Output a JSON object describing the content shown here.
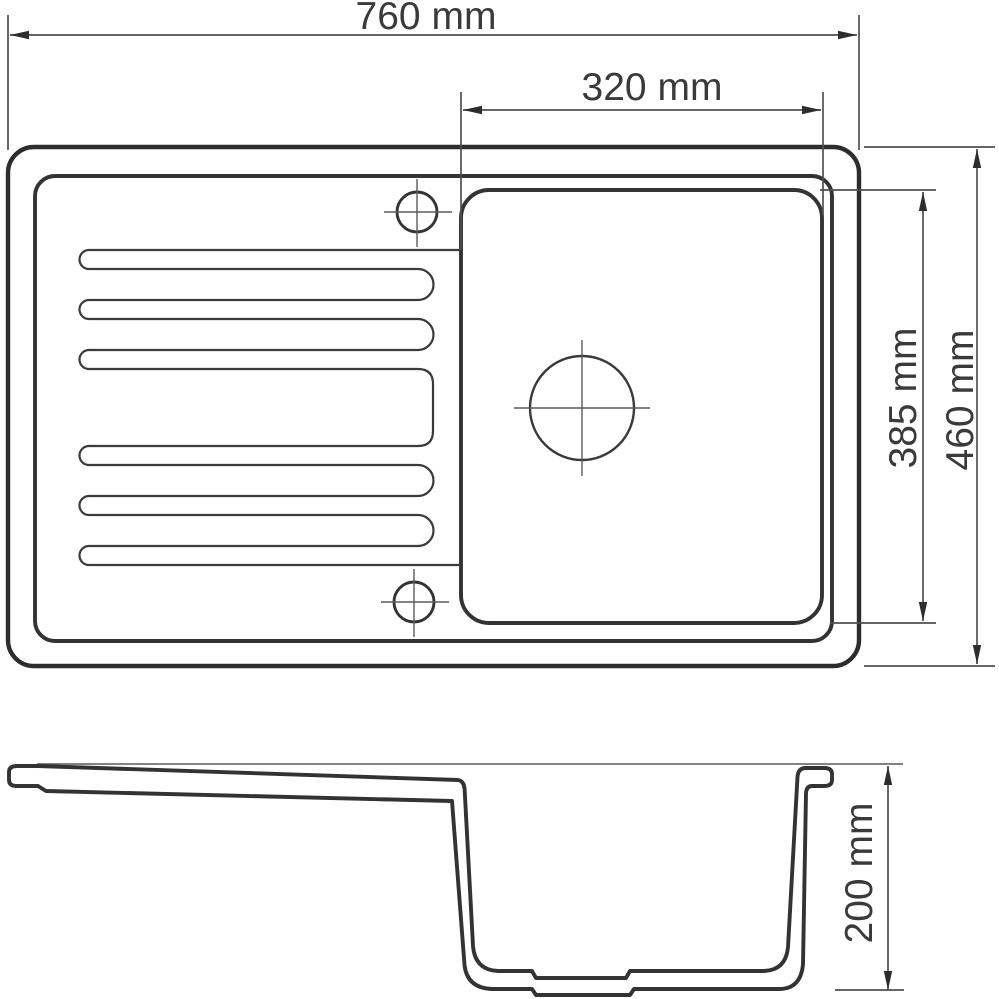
{
  "drawing": {
    "background": "#ffffff",
    "outline_color": "#2d2d2d",
    "thin_line_color": "#5a5a5a",
    "text_color": "#3a3a3a",
    "top_view": {
      "overall_width_label": "760 mm",
      "bowl_width_label": "320 mm",
      "bowl_depth_label": "385 mm",
      "overall_depth_label": "460 mm"
    },
    "side_view": {
      "bowl_height_label": "200 mm"
    }
  }
}
